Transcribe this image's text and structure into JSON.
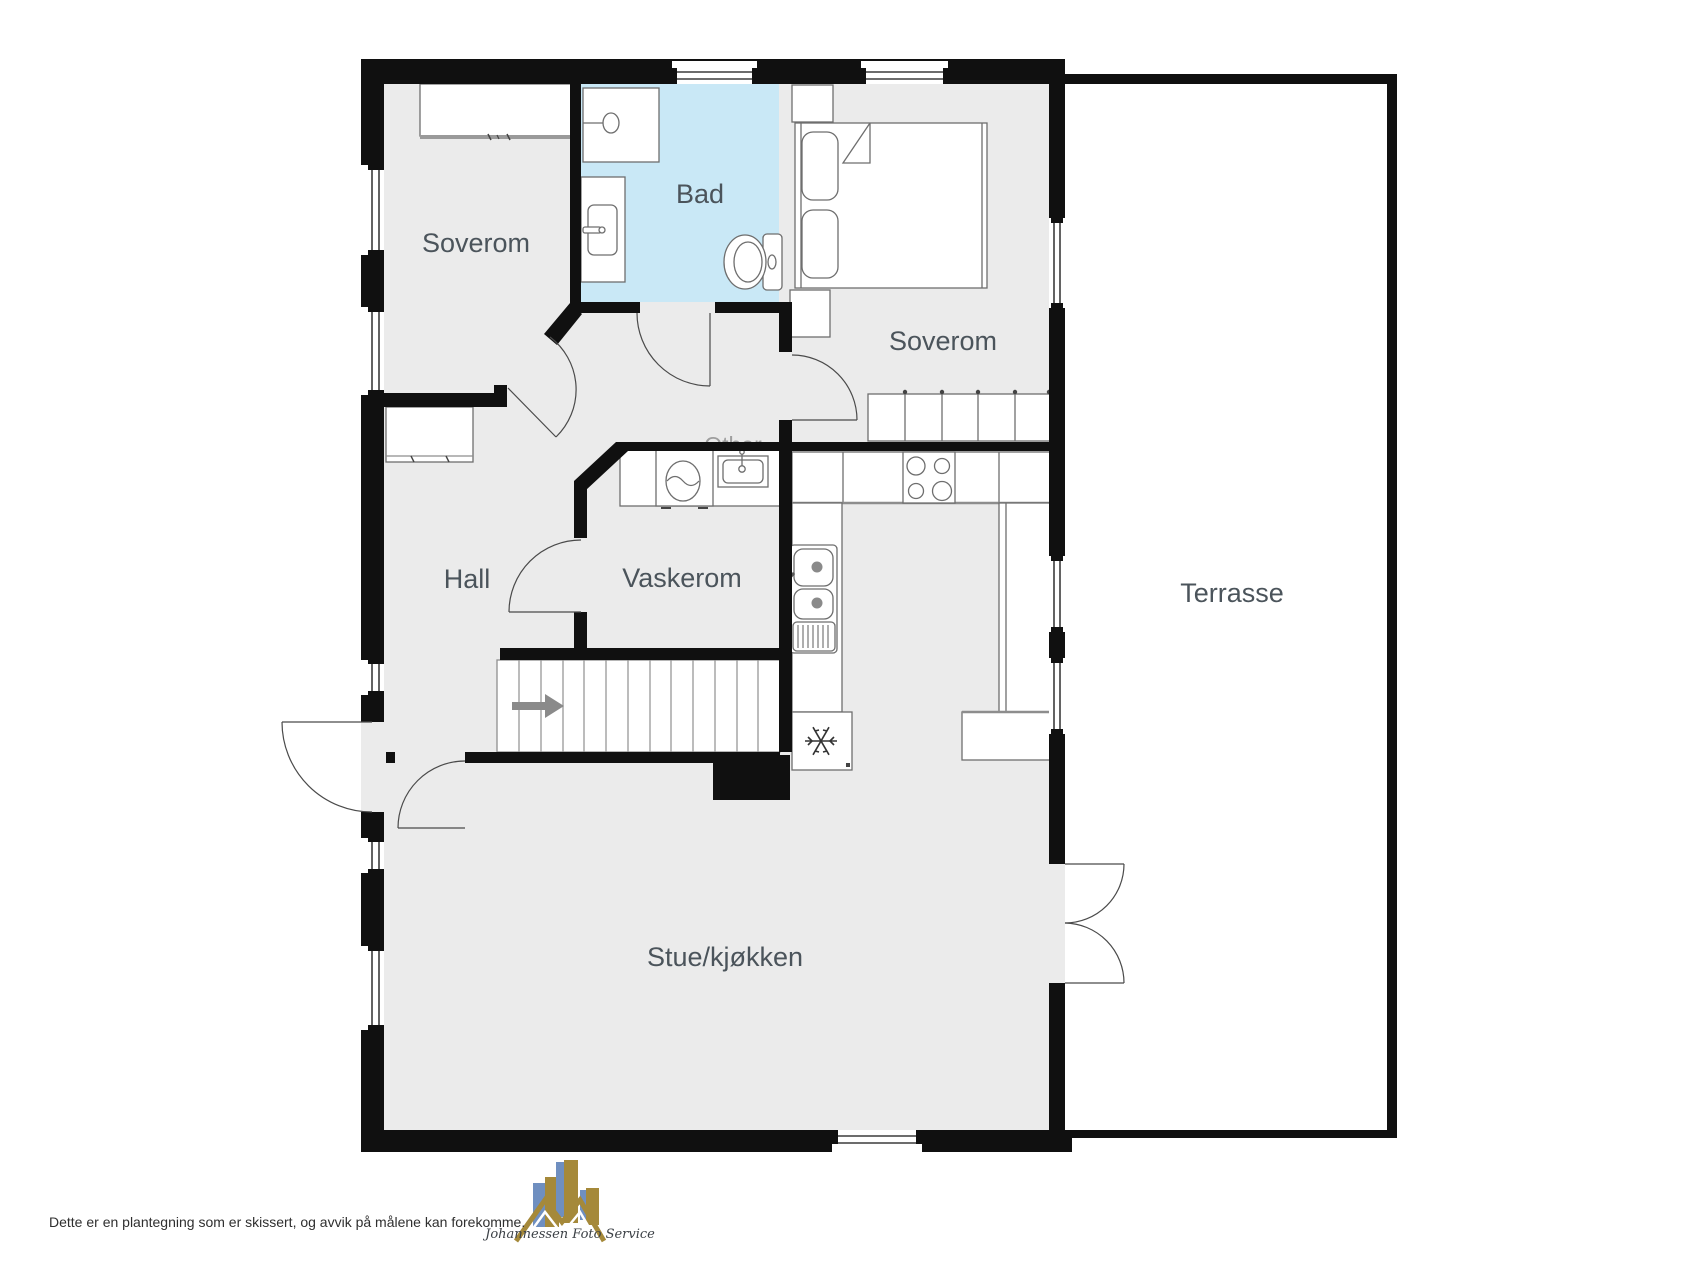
{
  "floorplan": {
    "rooms": {
      "bedroom1": "Soverom",
      "bathroom": "Bad",
      "bedroom2": "Soverom",
      "hall": "Hall",
      "laundry": "Vaskerom",
      "other": "Other",
      "terrace": "Terrasse",
      "living_kitchen": "Stue/kjøkken"
    },
    "colors": {
      "wall": "#101010",
      "floor": "#ebebeb",
      "bathroom_floor": "#c9e8f6",
      "terrace_floor": "#ffffff",
      "room_label": "#4b545b",
      "other_label": "#9e9e9e",
      "fixture_stroke": "#6e6e6e",
      "stairs_arrow": "#8a8a8a"
    },
    "icons": [
      "shower-icon",
      "sink-icon",
      "toilet-icon",
      "bed-icon",
      "wardrobe-icon",
      "washing-machine-icon",
      "laundry-sink-icon",
      "stove-icon",
      "kitchen-sink-icon",
      "freezer-snowflake-icon",
      "stairs-arrow-icon",
      "door-swing-icon",
      "window-icon"
    ]
  },
  "footer": {
    "disclaimer": "Dette er en plantegning som er skissert, og avvik på målene kan forekomme."
  },
  "logo": {
    "text": "Johannessen Foto Service",
    "gold": "#a5893a",
    "blue": "#6f8fc0"
  }
}
